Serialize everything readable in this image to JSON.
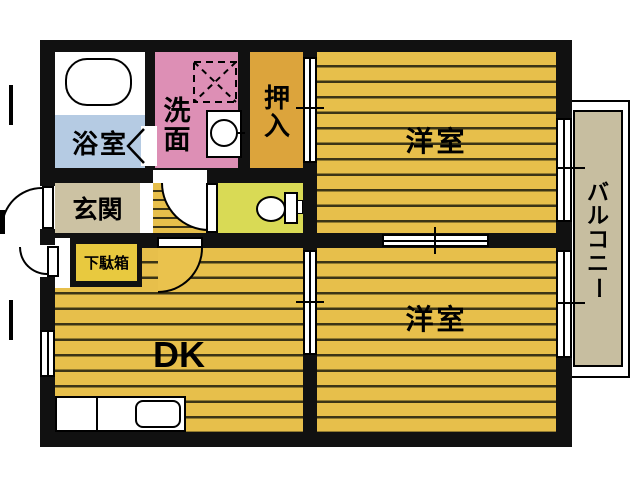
{
  "floorplan": {
    "rooms": {
      "bath": {
        "label": "浴室"
      },
      "washroom": {
        "label": "洗面"
      },
      "closet": {
        "label": "押入"
      },
      "bedroom_top": {
        "label": "洋室"
      },
      "bedroom_bottom": {
        "label": "洋室"
      },
      "entrance": {
        "label": "玄関"
      },
      "shoe_cabinet": {
        "label": "下駄箱"
      },
      "dining_kitchen": {
        "label": "DK"
      },
      "balcony": {
        "label": "バルコニー"
      }
    },
    "colors": {
      "wall": "#111111",
      "floor_base": "#e7bf4b",
      "floor_stripe": "#3b3416",
      "closet": "#dca43c",
      "washroom": "#dd8fb5",
      "bath": "#b5cbe3",
      "toilet_room": "#d9da55",
      "entrance": "#ccc2a3",
      "shoe_cabinet": "#e8c93f",
      "hall": "#eac24d",
      "balcony": "#c7bea0"
    }
  }
}
